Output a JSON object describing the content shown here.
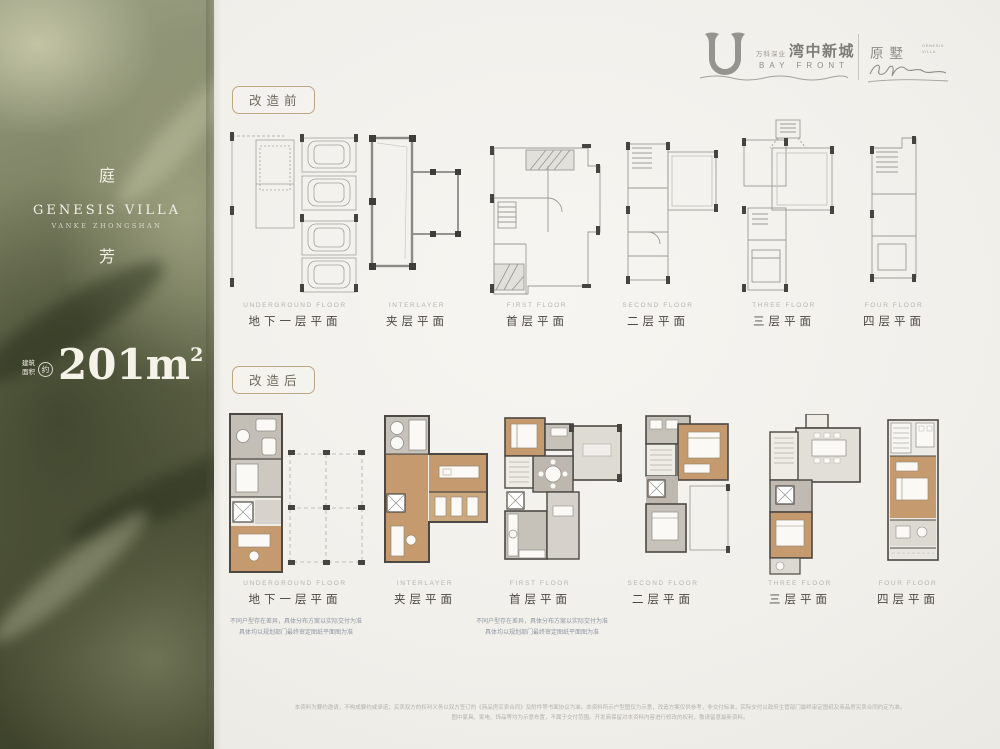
{
  "header": {
    "logo_cn_small": "万科深业",
    "logo_cn_large": "湾中新城",
    "logo_en": "BAY FRONT",
    "sub_brand": "原墅",
    "sub_small_1": "GENESIS",
    "sub_small_2": "VILLA"
  },
  "sidebar": {
    "title_top": "庭",
    "title_bottom": "芳",
    "subtitle_en": "GENESIS VILLA",
    "subtitle_small": "VANKE ZHONGSHAN",
    "area_label_1": "建筑",
    "area_label_2": "面积",
    "area_approx": "约",
    "area_value": "201m",
    "area_sup": "2"
  },
  "sections": {
    "before": {
      "badge": "改造前",
      "floors": [
        {
          "en": "UNDERGROUND FLOOR",
          "cn": "地下一层平面"
        },
        {
          "en": "INTERLAYER",
          "cn": "夹层平面"
        },
        {
          "en": "FIRST FLOOR",
          "cn": "首层平面"
        },
        {
          "en": "SECOND FLOOR",
          "cn": "二层平面"
        },
        {
          "en": "THREE FLOOR",
          "cn": "三层平面"
        },
        {
          "en": "FOUR FLOOR",
          "cn": "四层平面"
        }
      ]
    },
    "after": {
      "badge": "改造后",
      "floors": [
        {
          "en": "UNDERGROUND FLOOR",
          "cn": "地下一层平面"
        },
        {
          "en": "INTERLAYER",
          "cn": "夹层平面"
        },
        {
          "en": "FIRST FLOOR",
          "cn": "首层平面"
        },
        {
          "en": "SECOND FLOOR",
          "cn": "二层平面"
        },
        {
          "en": "THREE FLOOR",
          "cn": "三层平面"
        },
        {
          "en": "FOUR FLOOR",
          "cn": "四层平面"
        }
      ]
    }
  },
  "notes": {
    "line1": "不同户型存在差异，具体分布方案以实际交付为准",
    "line2": "具体均以规划部门最终审定图纸平面图为准"
  },
  "footer": {
    "line1": "本资料为要约邀请，不构成要约或承诺；买卖双方的权利义务以双方签订的《商品房买卖合同》及附件等书面协议为准。本资料所示户型图仅为示意，改造方案仅供参考，非交付标准，实际交付以政府主管部门最终审定图纸及商品房买卖合同约定为准。",
    "line2": "图中家具、家电、饰品等均为示意布置，不属于交付范围。开发商保留对本资料内容进行修改的权利，敬请留意最新资料。"
  }
}
